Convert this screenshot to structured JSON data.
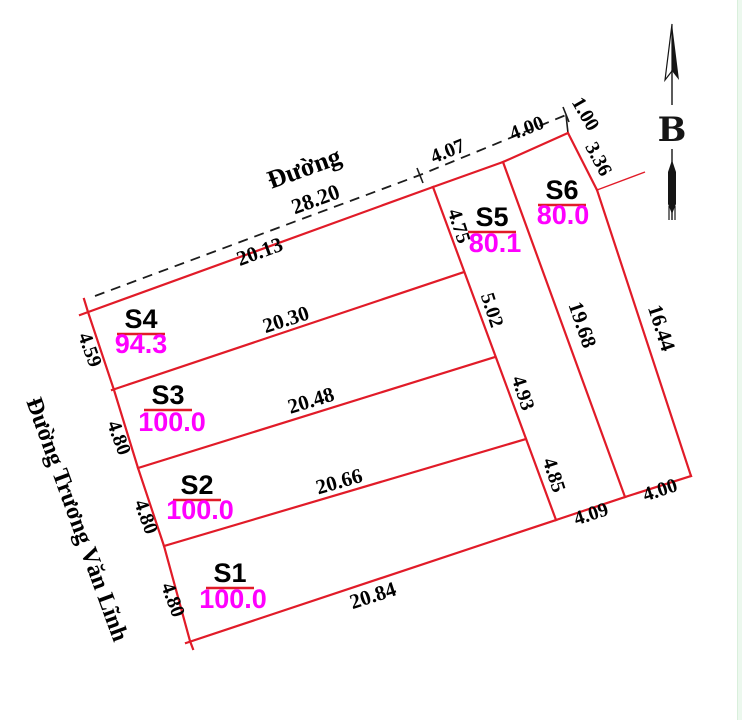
{
  "canvas": {
    "width": 742,
    "height": 720,
    "background": "#ffffff"
  },
  "colors": {
    "boundary": "#e11b28",
    "dashed_road": "#1c1c1c",
    "dim_text": "#000000",
    "area_text": "#ff00ff",
    "name_underline": "#e11b28",
    "leader": "#e11b28",
    "north": "#151515",
    "edge_strip": "#ecf8ee",
    "edge_strip_line": "#d9efdc"
  },
  "boundary_segments": [
    {
      "name": "left-edge",
      "points": [
        [
          84,
          299
        ],
        [
          88,
          312
        ],
        [
          114,
          390
        ],
        [
          138,
          468
        ],
        [
          164,
          546
        ],
        [
          190,
          641
        ],
        [
          193,
          649
        ]
      ]
    },
    {
      "name": "s4-top-edge",
      "points": [
        [
          80,
          315
        ],
        [
          433,
          187
        ]
      ]
    },
    {
      "name": "s4-s3-divider",
      "points": [
        [
          112,
          390
        ],
        [
          464,
          272
        ]
      ]
    },
    {
      "name": "s3-s2-divider",
      "points": [
        [
          138,
          468
        ],
        [
          495,
          357
        ]
      ]
    },
    {
      "name": "s2-s1-divider",
      "points": [
        [
          164,
          546
        ],
        [
          526,
          439
        ]
      ]
    },
    {
      "name": "bottom-edge",
      "points": [
        [
          186,
          643
        ],
        [
          556,
          520
        ]
      ]
    },
    {
      "name": "s5-left-edge",
      "points": [
        [
          433,
          187
        ],
        [
          556,
          520
        ]
      ]
    },
    {
      "name": "s5-top-edge",
      "points": [
        [
          433,
          187
        ],
        [
          503,
          162
        ]
      ]
    },
    {
      "name": "s5-s6-divider",
      "points": [
        [
          503,
          162
        ],
        [
          625,
          497
        ]
      ]
    },
    {
      "name": "s6-top-edge",
      "points": [
        [
          503,
          162
        ],
        [
          568,
          133
        ]
      ]
    },
    {
      "name": "s6-jog-edge",
      "points": [
        [
          568,
          133
        ],
        [
          597,
          190
        ]
      ]
    },
    {
      "name": "s6-right-edge",
      "points": [
        [
          597,
          190
        ],
        [
          691,
          476
        ]
      ]
    },
    {
      "name": "s6-bottom-edge",
      "points": [
        [
          625,
          497
        ],
        [
          691,
          476
        ]
      ]
    },
    {
      "name": "s5-bottom-edge",
      "points": [
        [
          556,
          520
        ],
        [
          625,
          497
        ]
      ]
    }
  ],
  "road_dashed_line": {
    "points": [
      [
        95,
        296
      ],
      [
        420,
        175
      ],
      [
        566,
        115
      ]
    ]
  },
  "ticks": [
    [
      417,
      168,
      423,
      183
    ],
    [
      563,
      107,
      569,
      122
    ]
  ],
  "connector_segment": [
    [
      566,
      115
    ],
    [
      568,
      133
    ]
  ],
  "leader_line": [
    [
      597,
      190
    ],
    [
      645,
      172
    ]
  ],
  "plots": [
    {
      "name": "S1",
      "area": "100.0",
      "nx": 230,
      "ny": 582,
      "ax": 233,
      "ay": 608
    },
    {
      "name": "S2",
      "area": "100.0",
      "nx": 197,
      "ny": 494,
      "ax": 200,
      "ay": 519
    },
    {
      "name": "S3",
      "area": "100.0",
      "nx": 168,
      "ny": 404,
      "ax": 172,
      "ay": 431
    },
    {
      "name": "S4",
      "area": "94.3",
      "nx": 141,
      "ny": 328,
      "ax": 141,
      "ay": 353
    },
    {
      "name": "S5",
      "area": "80.1",
      "nx": 492,
      "ny": 226,
      "ax": 495,
      "ay": 252
    },
    {
      "name": "S6",
      "area": "80.0",
      "nx": 562,
      "ny": 199,
      "ax": 563,
      "ay": 224
    }
  ],
  "dimensions": [
    {
      "text": "28.20",
      "x": 318,
      "y": 206,
      "rot": -20,
      "size": 22
    },
    {
      "text": "20.13",
      "x": 262,
      "y": 258,
      "rot": -20,
      "size": 21
    },
    {
      "text": "4.07",
      "x": 450,
      "y": 157,
      "rot": -22,
      "size": 20
    },
    {
      "text": "4.00",
      "x": 529,
      "y": 134,
      "rot": -21,
      "size": 20
    },
    {
      "text": "1.00",
      "x": 580,
      "y": 117,
      "rot": 60,
      "size": 20
    },
    {
      "text": "3.36",
      "x": 593,
      "y": 162,
      "rot": 62,
      "size": 20
    },
    {
      "text": "4.75",
      "x": 453,
      "y": 228,
      "rot": 72,
      "size": 20
    },
    {
      "text": "5.02",
      "x": 486,
      "y": 312,
      "rot": 72,
      "size": 20
    },
    {
      "text": "4.93",
      "x": 517,
      "y": 395,
      "rot": 72,
      "size": 20
    },
    {
      "text": "4.85",
      "x": 548,
      "y": 477,
      "rot": 72,
      "size": 20
    },
    {
      "text": "19.68",
      "x": 576,
      "y": 327,
      "rot": 71,
      "size": 21
    },
    {
      "text": "16.44",
      "x": 655,
      "y": 330,
      "rot": 72,
      "size": 21
    },
    {
      "text": "4.09",
      "x": 593,
      "y": 520,
      "rot": -18,
      "size": 20
    },
    {
      "text": "4.00",
      "x": 662,
      "y": 496,
      "rot": -18,
      "size": 20
    },
    {
      "text": "20.30",
      "x": 288,
      "y": 326,
      "rot": -18,
      "size": 21
    },
    {
      "text": "20.48",
      "x": 313,
      "y": 407,
      "rot": -17,
      "size": 21
    },
    {
      "text": "20.66",
      "x": 341,
      "y": 488,
      "rot": -16,
      "size": 21
    },
    {
      "text": "20.84",
      "x": 375,
      "y": 602,
      "rot": -18,
      "size": 21
    },
    {
      "text": "4.59",
      "x": 84,
      "y": 352,
      "rot": 70,
      "size": 20
    },
    {
      "text": "4.80",
      "x": 113,
      "y": 440,
      "rot": 70,
      "size": 20
    },
    {
      "text": "4.80",
      "x": 140,
      "y": 519,
      "rot": 70,
      "size": 20
    },
    {
      "text": "4.80",
      "x": 167,
      "y": 602,
      "rot": 70,
      "size": 20
    }
  ],
  "road_labels": [
    {
      "id": "road-name-top",
      "text": "Đường",
      "x": 307,
      "y": 176,
      "rot": -20,
      "size": 26
    },
    {
      "id": "road-name-left",
      "text": "Đường Trương Văn Lĩnh",
      "x": 70,
      "y": 522,
      "rot": 70,
      "size": 24
    }
  ],
  "north_arrow": {
    "x": 672,
    "top": 24,
    "bottom": 220,
    "letter": "B",
    "letter_y": 141,
    "letter_size": 34
  }
}
